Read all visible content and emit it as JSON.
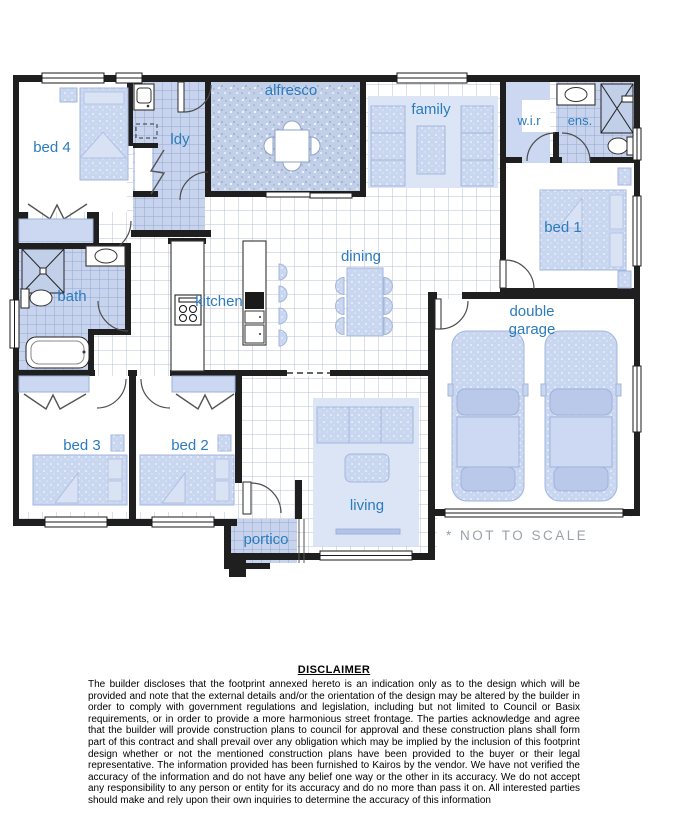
{
  "plan": {
    "rooms": {
      "bed4": "bed 4",
      "ldy": "ldy",
      "alfresco": "alfresco",
      "family": "family",
      "wir": "w.i.r",
      "ens": "ens.",
      "bed1": "bed 1",
      "bath": "bath",
      "kitchen": "kitchen",
      "dining": "dining",
      "garage1": "double",
      "garage2": "garage",
      "bed3": "bed 3",
      "bed2": "bed 2",
      "living": "living",
      "portico": "portico"
    },
    "note": "* NOT TO SCALE"
  },
  "disclaimer": {
    "title": "DISCLAIMER",
    "body": "The builder discloses that the footprint annexed hereto is an indication only as to the design which will be provided and note that the external details and/or the orientation of the design may be altered by the builder in order to comply with government regulations and legislation, including but not limited to Council or Basix requirements, or in order to provide a more harmonious street frontage. The parties acknowledge and agree that the builder will provide construction plans to council for approval and these construction plans shall form part of this contract and shall prevail over any obligation which may be implied by the inclusion of this footprint design whether or not the mentioned construction plans have been provided to the buyer or their legal representative. The information provided has been furnished to Kairos by the vendor. We have not verified the accuracy of the information and do not have any belief one way or the other in its accuracy. We do not accept any responsibility to any person or entity for its accuracy and do no more than pass it on. All interested parties should make and rely upon their own inquiries to determine the accuracy of this information"
  },
  "colors": {
    "label_blue": "#2b7bbd",
    "wall": "#1f1f1f",
    "tile": "#c8d4ee",
    "tile_line": "#94a8d0",
    "floor_grid_line": "#b7c1d7",
    "furniture": "#c9d6f0",
    "rug": "#d9e3f4",
    "note_gray": "#9aa1a9"
  }
}
